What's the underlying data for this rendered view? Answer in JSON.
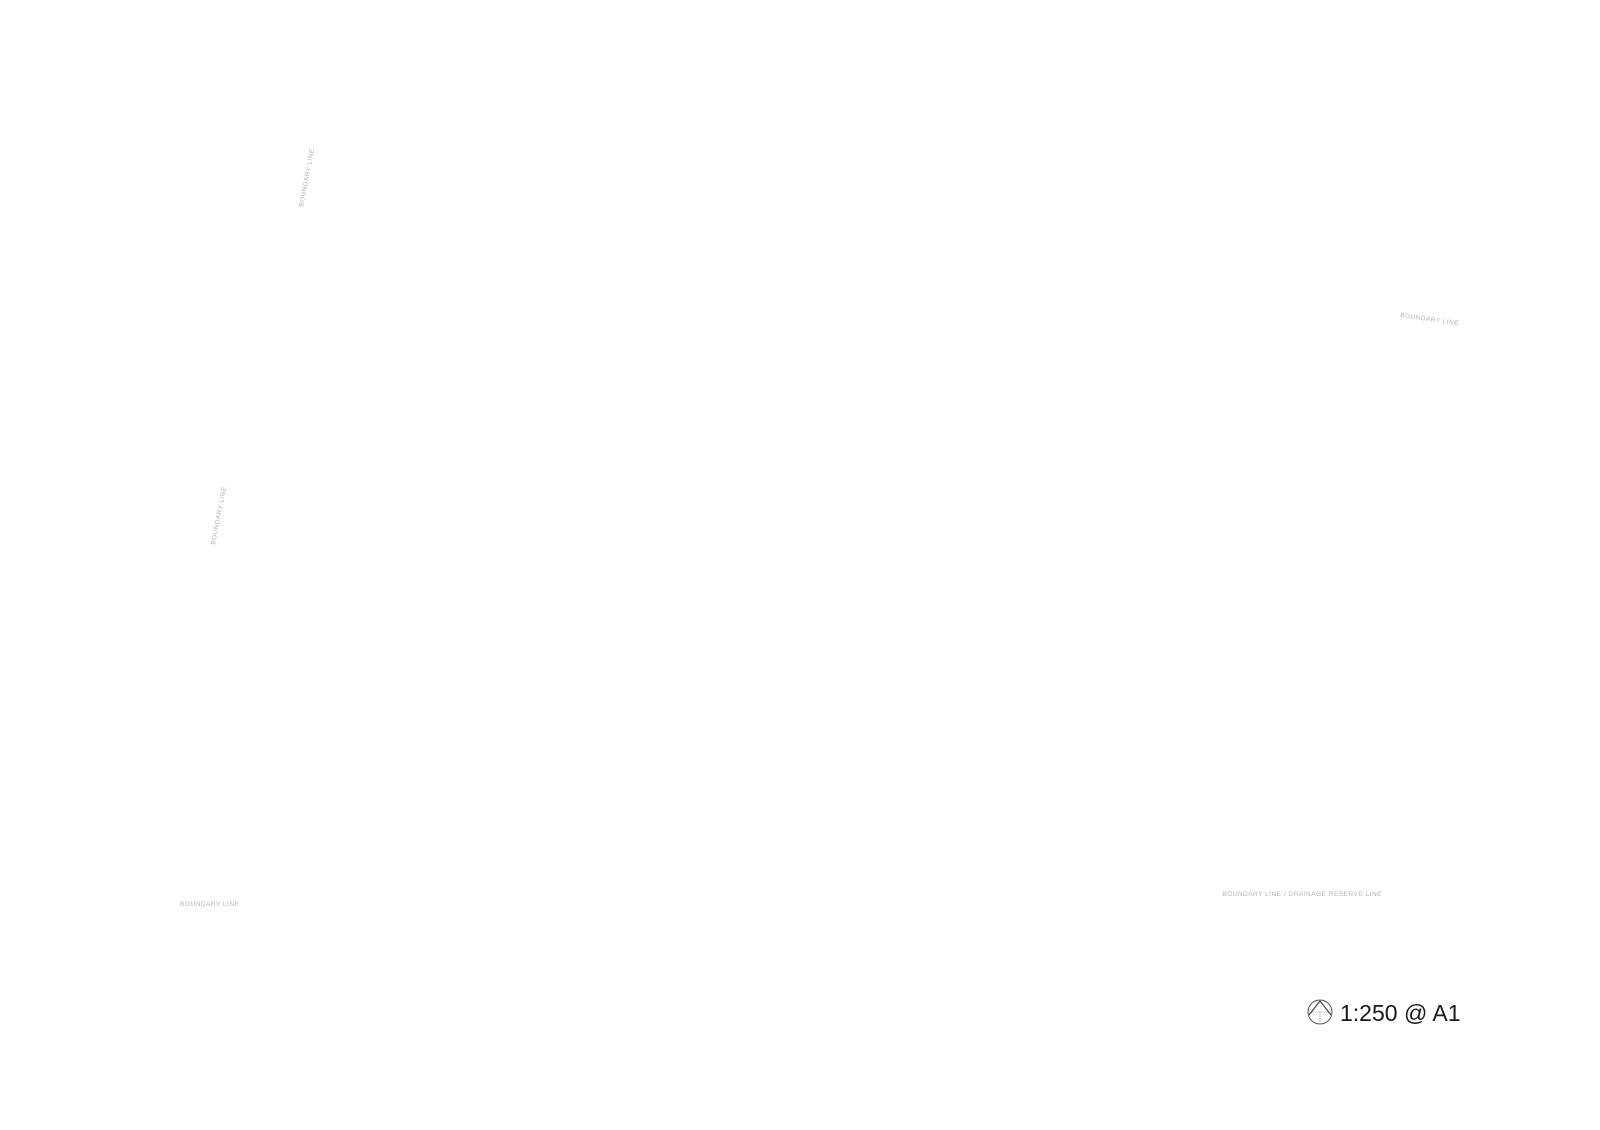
{
  "scale_note": {
    "icon": "north-arrow-icon",
    "label": "1:250 @ A1"
  },
  "boundary_labels": {
    "top_left": "BOUNDARY LINE",
    "left": "BOUNDARY LINE",
    "bottom_left": "BOUNDARY LINE",
    "bottom_right": "BOUNDARY LINE / DRAINAGE RESERVE LINE",
    "top_right": "BOUNDARY LINE"
  },
  "colors": {
    "background": "#ffffff",
    "site_lawn": "#e9f0d4",
    "perimeter_band": "#dce8b6",
    "bottom_band": "#d6e3ab",
    "court_lawn": "#dde9c0",
    "court_line": "#a7b37f",
    "water": "#a9c6d1",
    "water_edge": "#8fb2bd",
    "water_rim": "#d8e4e8",
    "wave_line": "#bcd3da",
    "deck_tan": "#c9bbab",
    "deck_edge": "#b0a090",
    "building_fill": "#ffffff",
    "building_line": "#8a8a8a",
    "roof_strip": "#b6a898",
    "gray_building": "#d9d9d7",
    "plaza_fill": "#fbfcfc",
    "big_tree_dark": "#2a6a45",
    "big_tree_mid": "#3f8f5c",
    "big_tree_light": "#67b07b",
    "island_tree": "#b3a64e",
    "island_tree_line": "#6f6627",
    "linework": "#9aa3ad",
    "dim_line": "#c7cbd0",
    "label_text": "#b0b4b8",
    "scale_text": "#1a1a1a",
    "palm_fill": "#c8dd96",
    "palm_line": "#93ad62",
    "tree_palette": [
      [
        "#aacb82",
        "#6d9150"
      ],
      [
        "#97c073",
        "#5d8545"
      ],
      [
        "#bcd795",
        "#7ea25b"
      ],
      [
        "#8ab369",
        "#547e40"
      ],
      [
        "#c4db9d",
        "#87a961"
      ]
    ]
  }
}
